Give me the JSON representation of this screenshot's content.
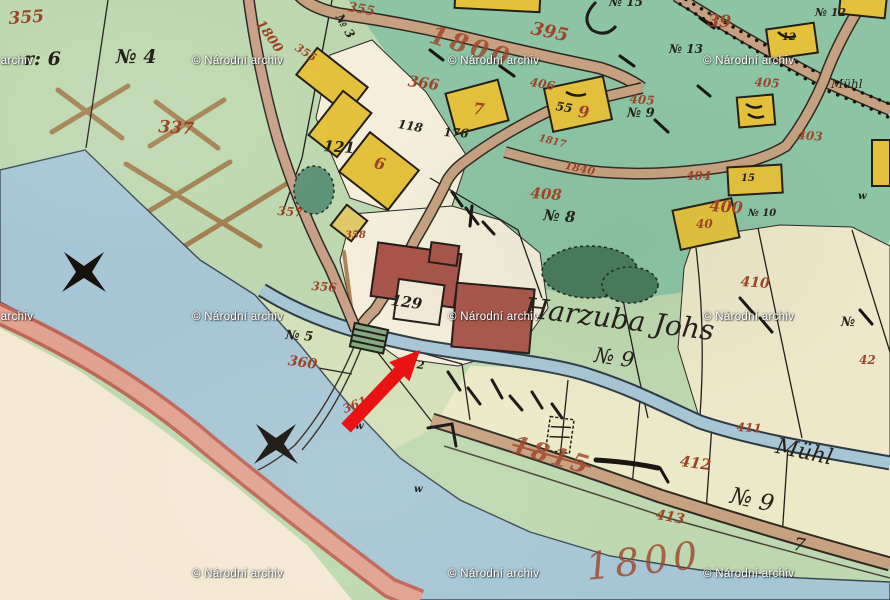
{
  "meta": {
    "description": "Scanned historical hand-drawn cadastral map sheet with archive watermark and red arrow annotation"
  },
  "palette": {
    "paper_green": "#bdd8b0",
    "teal_green": "#8cc4a4",
    "cream_field": "#eee7ca",
    "river_blue": "#a6c5d5",
    "road_tan": "#c6a181",
    "pink_road": "#e2a191",
    "building_yellow": "#e4c13c",
    "building_red": "#a9544a",
    "red_ink": "#9e4429",
    "black_ink": "#26221a",
    "arrow_red": "#ea1212"
  },
  "watermark": {
    "text": "© Národní archiv",
    "full_positions": [
      [
        192,
        55
      ],
      [
        448,
        55
      ],
      [
        703,
        55
      ],
      [
        192,
        311
      ],
      [
        448,
        311
      ],
      [
        703,
        311
      ],
      [
        192,
        568
      ],
      [
        448,
        568
      ],
      [
        703,
        568
      ]
    ],
    "partial_positions": [
      [
        -58,
        55
      ],
      [
        -58,
        311
      ]
    ]
  },
  "annotation_arrow": {
    "color": "#ea1212",
    "tail_x": 346,
    "tail_y": 428,
    "tip_x": 420,
    "tip_y": 350,
    "direction": "pointing-northeast-at-red-building"
  },
  "labels": [
    {
      "text": "355",
      "x": 8,
      "y": 11,
      "ink": "red",
      "size": 17,
      "rot": -4
    },
    {
      "text": "337",
      "x": 159,
      "y": 119,
      "ink": "red",
      "size": 17,
      "rot": 4
    },
    {
      "text": "1800",
      "x": 264,
      "y": 18,
      "ink": "red",
      "size": 13,
      "rot": 55
    },
    {
      "text": "355",
      "x": 299,
      "y": 42,
      "ink": "red",
      "size": 11,
      "rot": 32
    },
    {
      "text": "355",
      "x": 349,
      "y": 1,
      "ink": "red",
      "size": 13,
      "rot": 10
    },
    {
      "text": "1800",
      "x": 434,
      "y": 22,
      "ink": "red",
      "size": 25,
      "rot": 17,
      "ls": 4,
      "fade": true
    },
    {
      "text": "395",
      "x": 533,
      "y": 20,
      "ink": "red",
      "size": 18,
      "rot": 12
    },
    {
      "text": "366",
      "x": 409,
      "y": 74,
      "ink": "red",
      "size": 15,
      "rot": 8
    },
    {
      "text": "406",
      "x": 531,
      "y": 76,
      "ink": "red",
      "size": 12,
      "rot": 10
    },
    {
      "text": "39",
      "x": 708,
      "y": 13,
      "ink": "red",
      "size": 17,
      "rot": 4
    },
    {
      "text": "405",
      "x": 755,
      "y": 76,
      "ink": "red",
      "size": 12,
      "rot": 4
    },
    {
      "text": "405",
      "x": 630,
      "y": 93,
      "ink": "red",
      "size": 12,
      "rot": 4
    },
    {
      "text": "403",
      "x": 798,
      "y": 129,
      "ink": "red",
      "size": 12,
      "rot": 4
    },
    {
      "text": "404",
      "x": 686,
      "y": 170,
      "ink": "red",
      "size": 12,
      "rot": 0
    },
    {
      "text": "408",
      "x": 531,
      "y": 186,
      "ink": "red",
      "size": 15,
      "rot": 4
    },
    {
      "text": "400",
      "x": 710,
      "y": 198,
      "ink": "red",
      "size": 16,
      "rot": 4
    },
    {
      "text": "410",
      "x": 741,
      "y": 275,
      "ink": "red",
      "size": 14,
      "rot": 4
    },
    {
      "text": "42",
      "x": 859,
      "y": 354,
      "ink": "red",
      "size": 12,
      "rot": 0
    },
    {
      "text": "1817",
      "x": 540,
      "y": 134,
      "ink": "red",
      "size": 10,
      "rot": 14
    },
    {
      "text": "1840",
      "x": 566,
      "y": 160,
      "ink": "red",
      "size": 11,
      "rot": 12
    },
    {
      "text": "6",
      "x": 376,
      "y": 155,
      "ink": "red",
      "size": 16,
      "rot": 12
    },
    {
      "text": "7",
      "x": 474,
      "y": 101,
      "ink": "red",
      "size": 16,
      "rot": 6
    },
    {
      "text": "9",
      "x": 579,
      "y": 104,
      "ink": "red",
      "size": 16,
      "rot": 6
    },
    {
      "text": "40",
      "x": 696,
      "y": 218,
      "ink": "red",
      "size": 12,
      "rot": 0
    },
    {
      "text": "357",
      "x": 278,
      "y": 205,
      "ink": "red",
      "size": 12,
      "rot": 4
    },
    {
      "text": "358",
      "x": 345,
      "y": 231,
      "ink": "red",
      "size": 10,
      "rot": 0
    },
    {
      "text": "356",
      "x": 312,
      "y": 280,
      "ink": "red",
      "size": 12,
      "rot": 4
    },
    {
      "text": "360",
      "x": 289,
      "y": 354,
      "ink": "red",
      "size": 14,
      "rot": 8
    },
    {
      "text": "361",
      "x": 341,
      "y": 404,
      "ink": "red",
      "size": 12,
      "rot": -22
    },
    {
      "text": "411",
      "x": 737,
      "y": 421,
      "ink": "red",
      "size": 12,
      "rot": 4
    },
    {
      "text": "412",
      "x": 681,
      "y": 454,
      "ink": "red",
      "size": 15,
      "rot": 8
    },
    {
      "text": "413",
      "x": 657,
      "y": 508,
      "ink": "red",
      "size": 14,
      "rot": 10
    },
    {
      "text": "1815",
      "x": 516,
      "y": 432,
      "ink": "red",
      "size": 25,
      "rot": 16,
      "ls": 3,
      "strike": true,
      "fade": true
    },
    {
      "text": "1800",
      "x": 584,
      "y": 548,
      "ink": "red",
      "size": 38,
      "rot": -6,
      "ls": 5,
      "fade": true,
      "style": "cursive"
    },
    {
      "text": "r: 6",
      "x": 24,
      "y": 50,
      "ink": "black",
      "size": 19
    },
    {
      "text": "№ 4",
      "x": 116,
      "y": 48,
      "ink": "black",
      "size": 19
    },
    {
      "text": "№ 3",
      "x": 344,
      "y": 12,
      "ink": "black",
      "size": 12,
      "rot": 60
    },
    {
      "text": "№ 15",
      "x": 609,
      "y": -4,
      "ink": "black",
      "size": 12
    },
    {
      "text": "№ 13",
      "x": 669,
      "y": 43,
      "ink": "black",
      "size": 12
    },
    {
      "text": "№ 12",
      "x": 815,
      "y": 7,
      "ink": "black",
      "size": 11
    },
    {
      "text": "№ 9",
      "x": 627,
      "y": 107,
      "ink": "black",
      "size": 13
    },
    {
      "text": "№ 8",
      "x": 544,
      "y": 208,
      "ink": "black",
      "size": 15,
      "rot": 4
    },
    {
      "text": "№ 10",
      "x": 748,
      "y": 209,
      "ink": "black",
      "size": 10
    },
    {
      "text": "121",
      "x": 324,
      "y": 139,
      "ink": "black",
      "size": 15,
      "rot": 4
    },
    {
      "text": "118",
      "x": 399,
      "y": 118,
      "ink": "black",
      "size": 12,
      "rot": 10
    },
    {
      "text": "176",
      "x": 444,
      "y": 126,
      "ink": "black",
      "size": 12,
      "rot": 4
    },
    {
      "text": "129",
      "x": 392,
      "y": 293,
      "ink": "black",
      "size": 15,
      "rot": 8
    },
    {
      "text": "55",
      "x": 557,
      "y": 100,
      "ink": "black",
      "size": 12,
      "rot": 10
    },
    {
      "text": "15",
      "x": 741,
      "y": 174,
      "ink": "black",
      "size": 10
    },
    {
      "text": "12",
      "x": 782,
      "y": 33,
      "ink": "black",
      "size": 10
    },
    {
      "text": "№ 5",
      "x": 286,
      "y": 329,
      "ink": "black",
      "size": 13,
      "rot": 4
    },
    {
      "text": "№ 2",
      "x": 402,
      "y": 357,
      "ink": "black",
      "size": 11,
      "rot": 8
    },
    {
      "text": "Harzuba Johs",
      "x": 526,
      "y": 294,
      "ink": "black",
      "size": 28,
      "rot": 7,
      "style": "cursive"
    },
    {
      "text": "№ 9",
      "x": 596,
      "y": 345,
      "ink": "black",
      "size": 21,
      "rot": 8,
      "style": "cursive"
    },
    {
      "text": "№ 9",
      "x": 733,
      "y": 485,
      "ink": "black",
      "size": 23,
      "rot": 12,
      "style": "cursive"
    },
    {
      "text": "7",
      "x": 795,
      "y": 536,
      "ink": "black",
      "size": 18,
      "rot": 10,
      "style": "cursive"
    },
    {
      "text": "№",
      "x": 841,
      "y": 316,
      "ink": "black",
      "size": 13
    },
    {
      "text": "Mühl",
      "x": 831,
      "y": 78,
      "ink": "black",
      "size": 12,
      "style": "cursive"
    },
    {
      "text": "Mühl",
      "x": 778,
      "y": 436,
      "ink": "black",
      "size": 22,
      "rot": 12,
      "style": "cursive"
    },
    {
      "text": "w",
      "x": 355,
      "y": 422,
      "ink": "black",
      "size": 10
    },
    {
      "text": "w",
      "x": 414,
      "y": 485,
      "ink": "black",
      "size": 10
    },
    {
      "text": "w",
      "x": 858,
      "y": 192,
      "ink": "black",
      "size": 10
    }
  ]
}
